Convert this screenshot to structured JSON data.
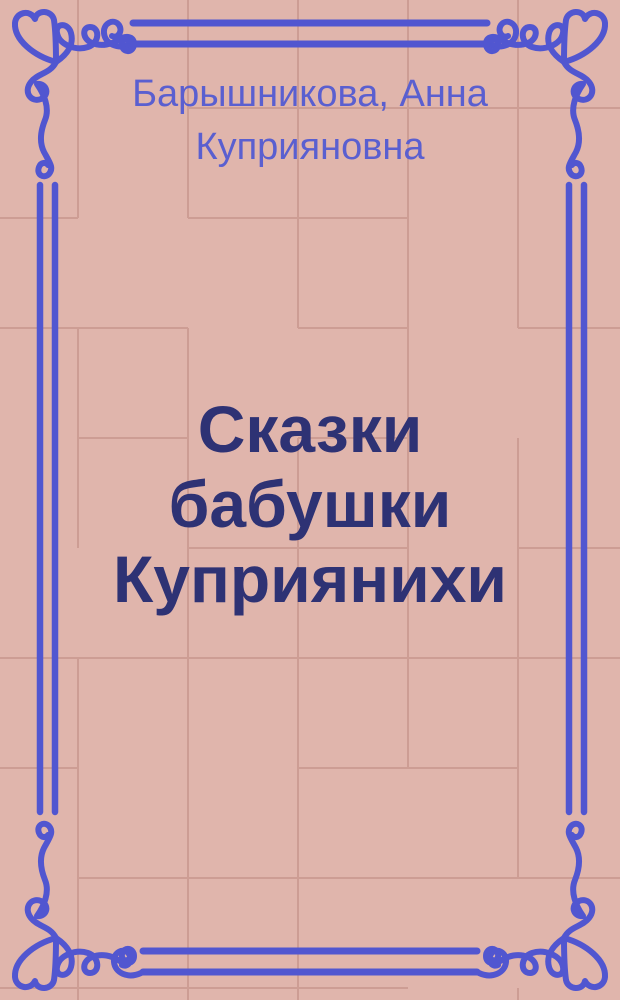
{
  "cover": {
    "author": "Барышникова, Анна Куприяновна",
    "title": "Сказки бабушки Куприянихи"
  },
  "colors": {
    "background": "#e0b5ac",
    "tile_line": "#c9998f",
    "border_blue": "#5156d0",
    "author_text": "#5a5fd0",
    "title_text": "#2e3274"
  }
}
